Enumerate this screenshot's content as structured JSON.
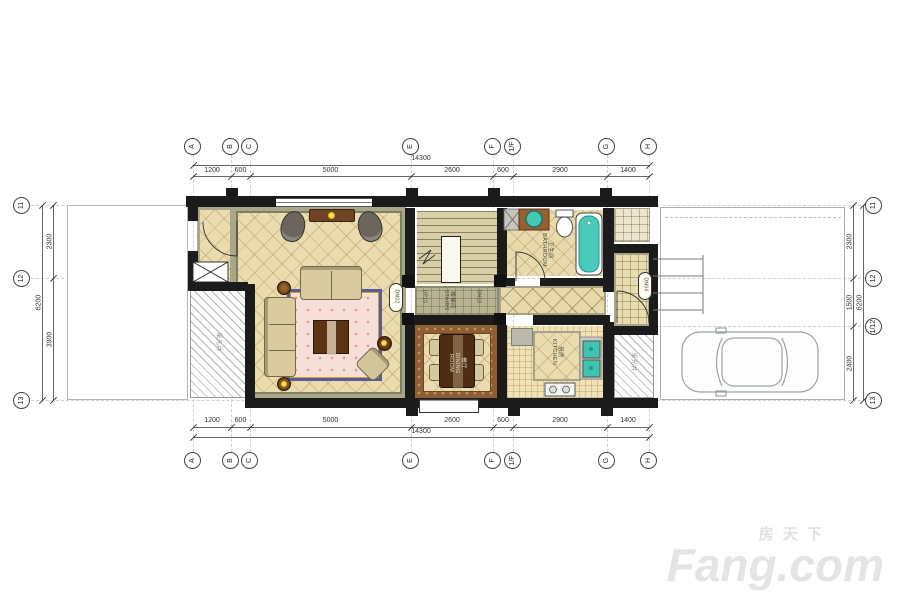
{
  "watermark": {
    "cn": "房天下",
    "en": "Fang.com"
  },
  "grid": {
    "cols": [
      "A",
      "B",
      "C",
      "E",
      "F",
      "1/F",
      "G",
      "H"
    ],
    "rows_left": [
      "11",
      "12",
      "13"
    ],
    "rows_right": [
      "11",
      "12",
      "1/12",
      "13"
    ]
  },
  "dims": {
    "top": {
      "total": "14300",
      "segments": [
        "1200",
        "600",
        "5000",
        "2600",
        "600",
        "2900",
        "1400"
      ]
    },
    "bottom": {
      "total": "14300",
      "segments": [
        "1200",
        "600",
        "5000",
        "2600",
        "600",
        "2900",
        "1400"
      ]
    },
    "left": {
      "total": "6200",
      "segments": [
        "2300",
        "3900"
      ]
    },
    "right": {
      "total": "6200",
      "segments": [
        "2300",
        "1500",
        "2400"
      ]
    }
  },
  "labels": {
    "stairs_cn": "楼梯间",
    "stairs_en": "STAIRS",
    "stairs_up": "UP10",
    "stairs_dn": "DN12",
    "bath_cn": "卫生间",
    "bath_en": "BATHROOM",
    "dining_cn": "餐厅",
    "dining_en": "DINING ROOM",
    "kitchen_cn": "厨房",
    "kitchen_en": "KITCHEN",
    "lightwell_left": "采光井",
    "lightwell_right": "采光井",
    "passage_code": "DN02",
    "entry_code": "DN04"
  },
  "colors": {
    "wall": "#1b1b1b",
    "teal_fixture": "#45c7b6",
    "tile": "#ebdcb0",
    "rug_border": "#5b5b97"
  }
}
